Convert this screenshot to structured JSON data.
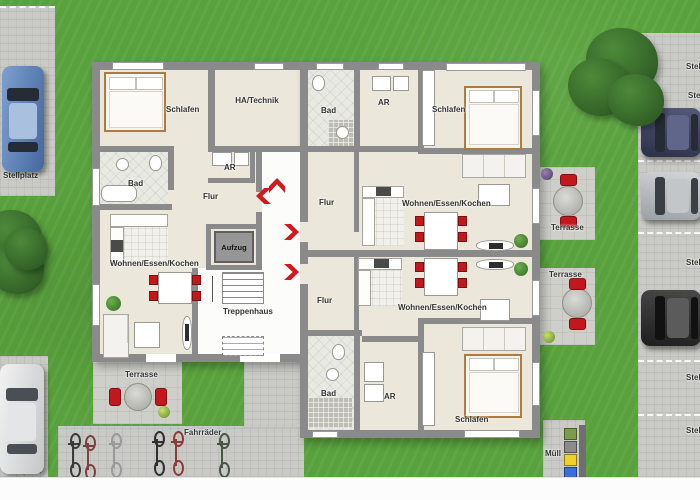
{
  "site": {
    "parking_top_left_label": "Stellplatz",
    "parking_bottom_left_label": "Stellplatz",
    "parking_right_stalls": [
      "Stellplatz",
      "Stellplatz",
      "Stellplatz",
      "Stellplatz",
      "Stellplatz",
      "Stellplatz"
    ],
    "bike_area_label": "Fahrräder",
    "waste_area_label": "Müll",
    "terrace_left_label": "Terrasse",
    "terrace_right_upper_label": "Terrasse",
    "terrace_right_lower_label": "Terrasse"
  },
  "core": {
    "ha_technik_label": "HA/Technik",
    "elevator_label": "Aufzug",
    "stairwell_label": "Treppenhaus"
  },
  "apartment_left": {
    "bedroom": "Schlafen",
    "bathroom": "Bad",
    "storage": "AR",
    "hallway": "Flur",
    "living": "Wohnen/Essen/Kochen"
  },
  "apartment_top_right": {
    "bedroom": "Schlafen",
    "bathroom": "Bad",
    "storage": "AR",
    "hallway": "Flur",
    "living": "Wohnen/Essen/Kochen"
  },
  "apartment_bottom_right": {
    "bedroom": "Schlafen",
    "bathroom": "Bad",
    "storage": "AR",
    "hallway": "Flur",
    "living": "Wohnen/Essen/Kochen"
  },
  "watermark": "© Illustration",
  "colors": {
    "grass": "#58a13c",
    "pavement": "#c9c9c5",
    "wall": "#8a8a8a",
    "floor": "#ebe7da",
    "accent_red": "#d11a20",
    "bins": [
      "#7d9c4a",
      "#8b8b8b",
      "#f0d12b",
      "#3a6fd8"
    ]
  }
}
